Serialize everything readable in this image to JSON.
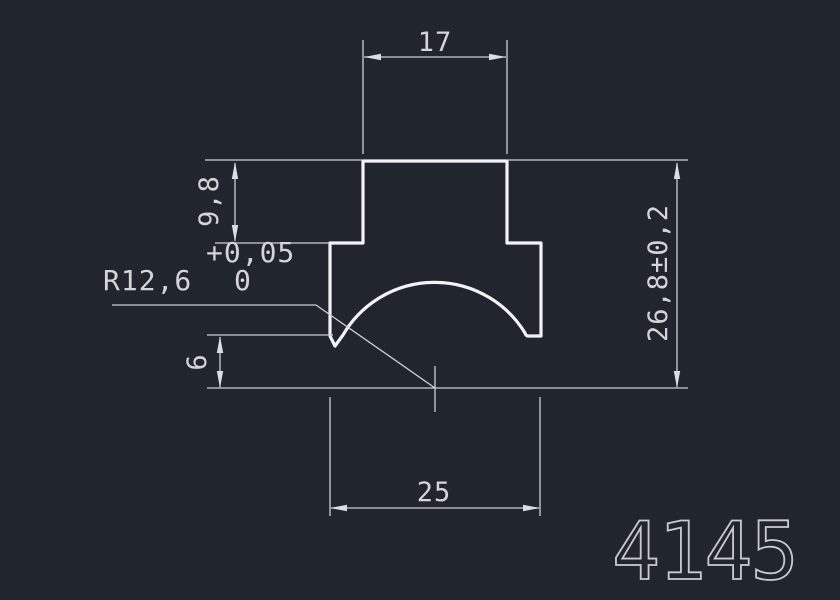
{
  "drawing": {
    "part_number": "4145",
    "labels": {
      "width_top": "17",
      "height_step": "9,8",
      "tol_upper": "+0,05",
      "tol_lower": "0",
      "radius": "R12,6",
      "height_foot": "6",
      "height_overall": "26,8±0,2",
      "width_base": "25"
    },
    "colors": {
      "background": "#21252d",
      "profile_line": "#f2f3f5",
      "dimension_line": "#cdd0d5",
      "dimension_text": "#d3d5d9",
      "part_number_text": "#c8cace"
    }
  }
}
